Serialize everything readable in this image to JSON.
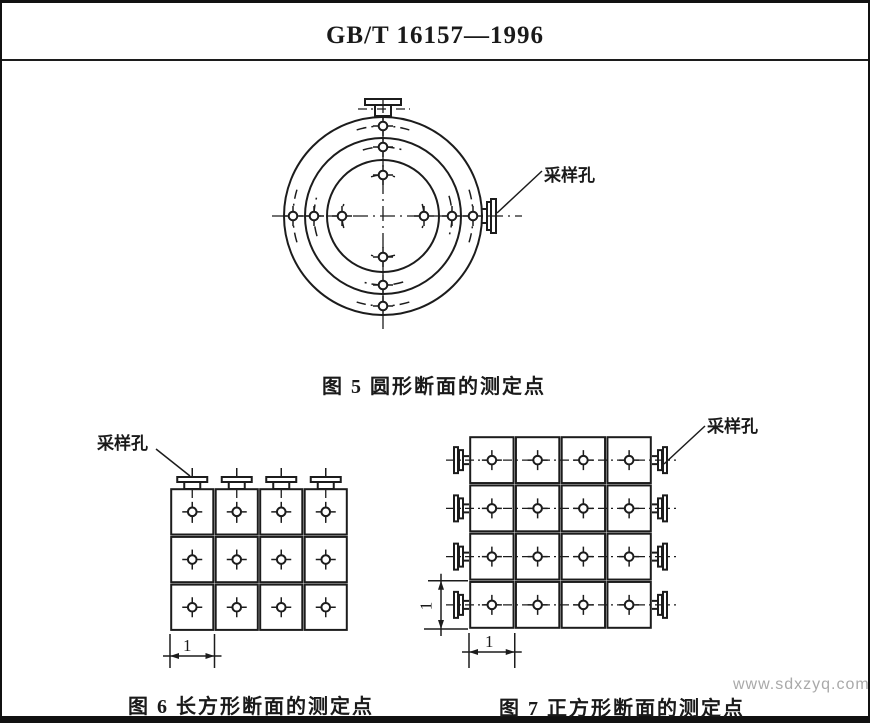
{
  "header": {
    "title": "GB/T 16157—1996"
  },
  "watermark": "www.sdxzyq.com",
  "labels": {
    "sampling_port": "采样孔",
    "dim": "1"
  },
  "fig5": {
    "caption": "图 5  圆形断面的测定点",
    "shape": "circular",
    "rings": 3,
    "points_per_diameter": 6,
    "total_points": 12,
    "sampling_ports": 2
  },
  "fig6": {
    "caption": "图 6  长方形断面的测定点",
    "shape": "rectangular",
    "cols": 4,
    "rows": 3,
    "total_points": 12,
    "sampling_ports": 4,
    "cell_width_label": "1"
  },
  "fig7": {
    "caption": "图 7  正方形断面的测定点",
    "shape": "square",
    "cols": 4,
    "rows": 4,
    "total_points": 16,
    "sampling_ports": 8,
    "cell_width_label": "1",
    "cell_height_label": "1"
  }
}
